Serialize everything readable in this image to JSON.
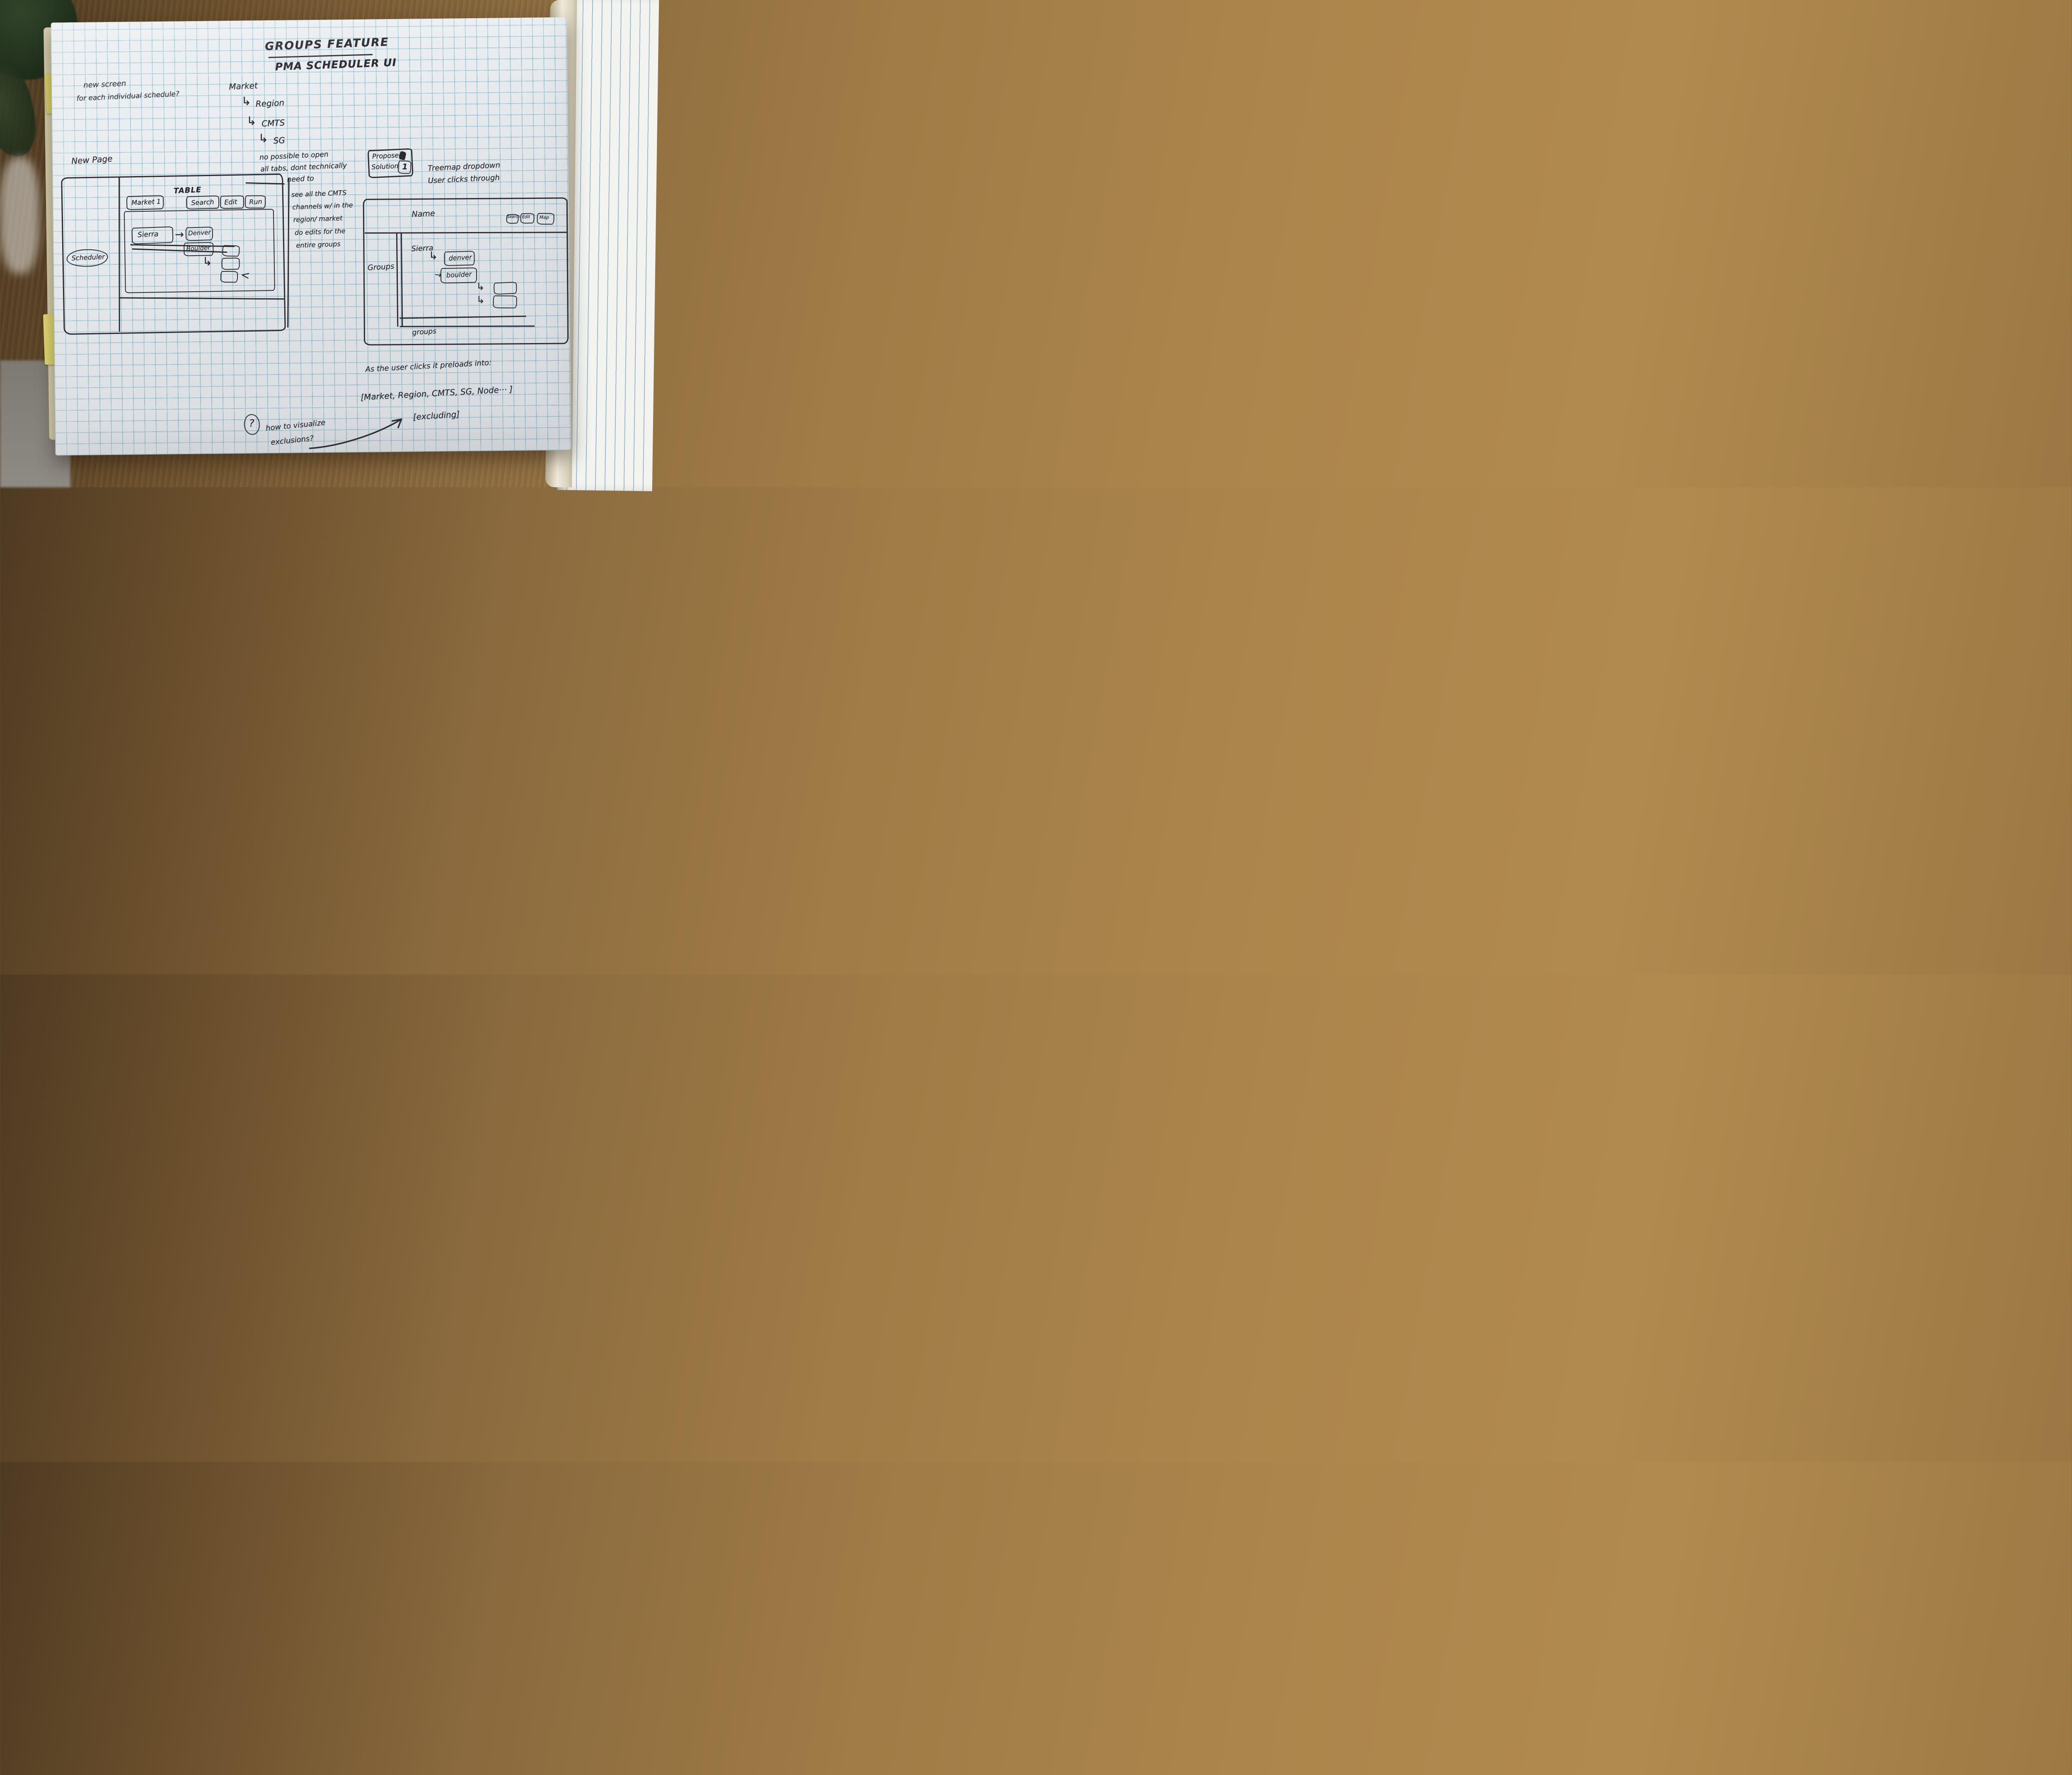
{
  "sketch": {
    "title": {
      "line1": "GROUPS FEATURE",
      "line2": "PMA SCHEDULER UI"
    },
    "notes": {
      "new_screen_1": "new screen",
      "new_screen_2": "for each individual schedule?",
      "hierarchy_root": "Market",
      "hierarchy_arrow": "↳",
      "hierarchy_levels": [
        "Region",
        "CMTS",
        "SG"
      ],
      "new_page": "New Page",
      "tabs_note_1": "no possible to open",
      "tabs_note_2": "all tabs, dont technically",
      "tabs_note_3": "need to",
      "cmts_note_1": "see all the CMTS",
      "cmts_note_2": "channels w/ in the",
      "cmts_note_3": "region/ market",
      "cmts_note_4": "do edits for the",
      "cmts_note_5": "entire groups",
      "proposed_1": "Proposed",
      "proposed_2": "Solution",
      "proposed_num": "1",
      "treemap_1": "Treemap dropdown",
      "treemap_2": "User clicks through",
      "preload_intro": "As the user clicks it preloads into:",
      "preload_list": "[Market, Region, CMTS, SG, Node··· ]",
      "excluding": "[excluding]",
      "question": "?",
      "how_to_1": "how to visualize",
      "how_to_2": "exclusions?"
    },
    "left_panel": {
      "table_label": "TABLE",
      "tab": "Market 1",
      "buttons": [
        "Search",
        "Edit",
        "Run"
      ],
      "sidebar_item": "Scheduler",
      "parent": "Sierra",
      "arrow_right": "→",
      "arrow_sub": "↳",
      "children": [
        "Denver",
        "Boulder"
      ],
      "tick": "<"
    },
    "right_panel": {
      "name_label": "Name",
      "header_buttons": [
        "Search",
        "Edit",
        "Map"
      ],
      "groups_label": "Groups",
      "parent": "Sierra",
      "arrow_sub": "↳",
      "arrow_right": "→",
      "children": [
        "denver",
        "boulder"
      ],
      "bottom_label": "groups"
    }
  }
}
